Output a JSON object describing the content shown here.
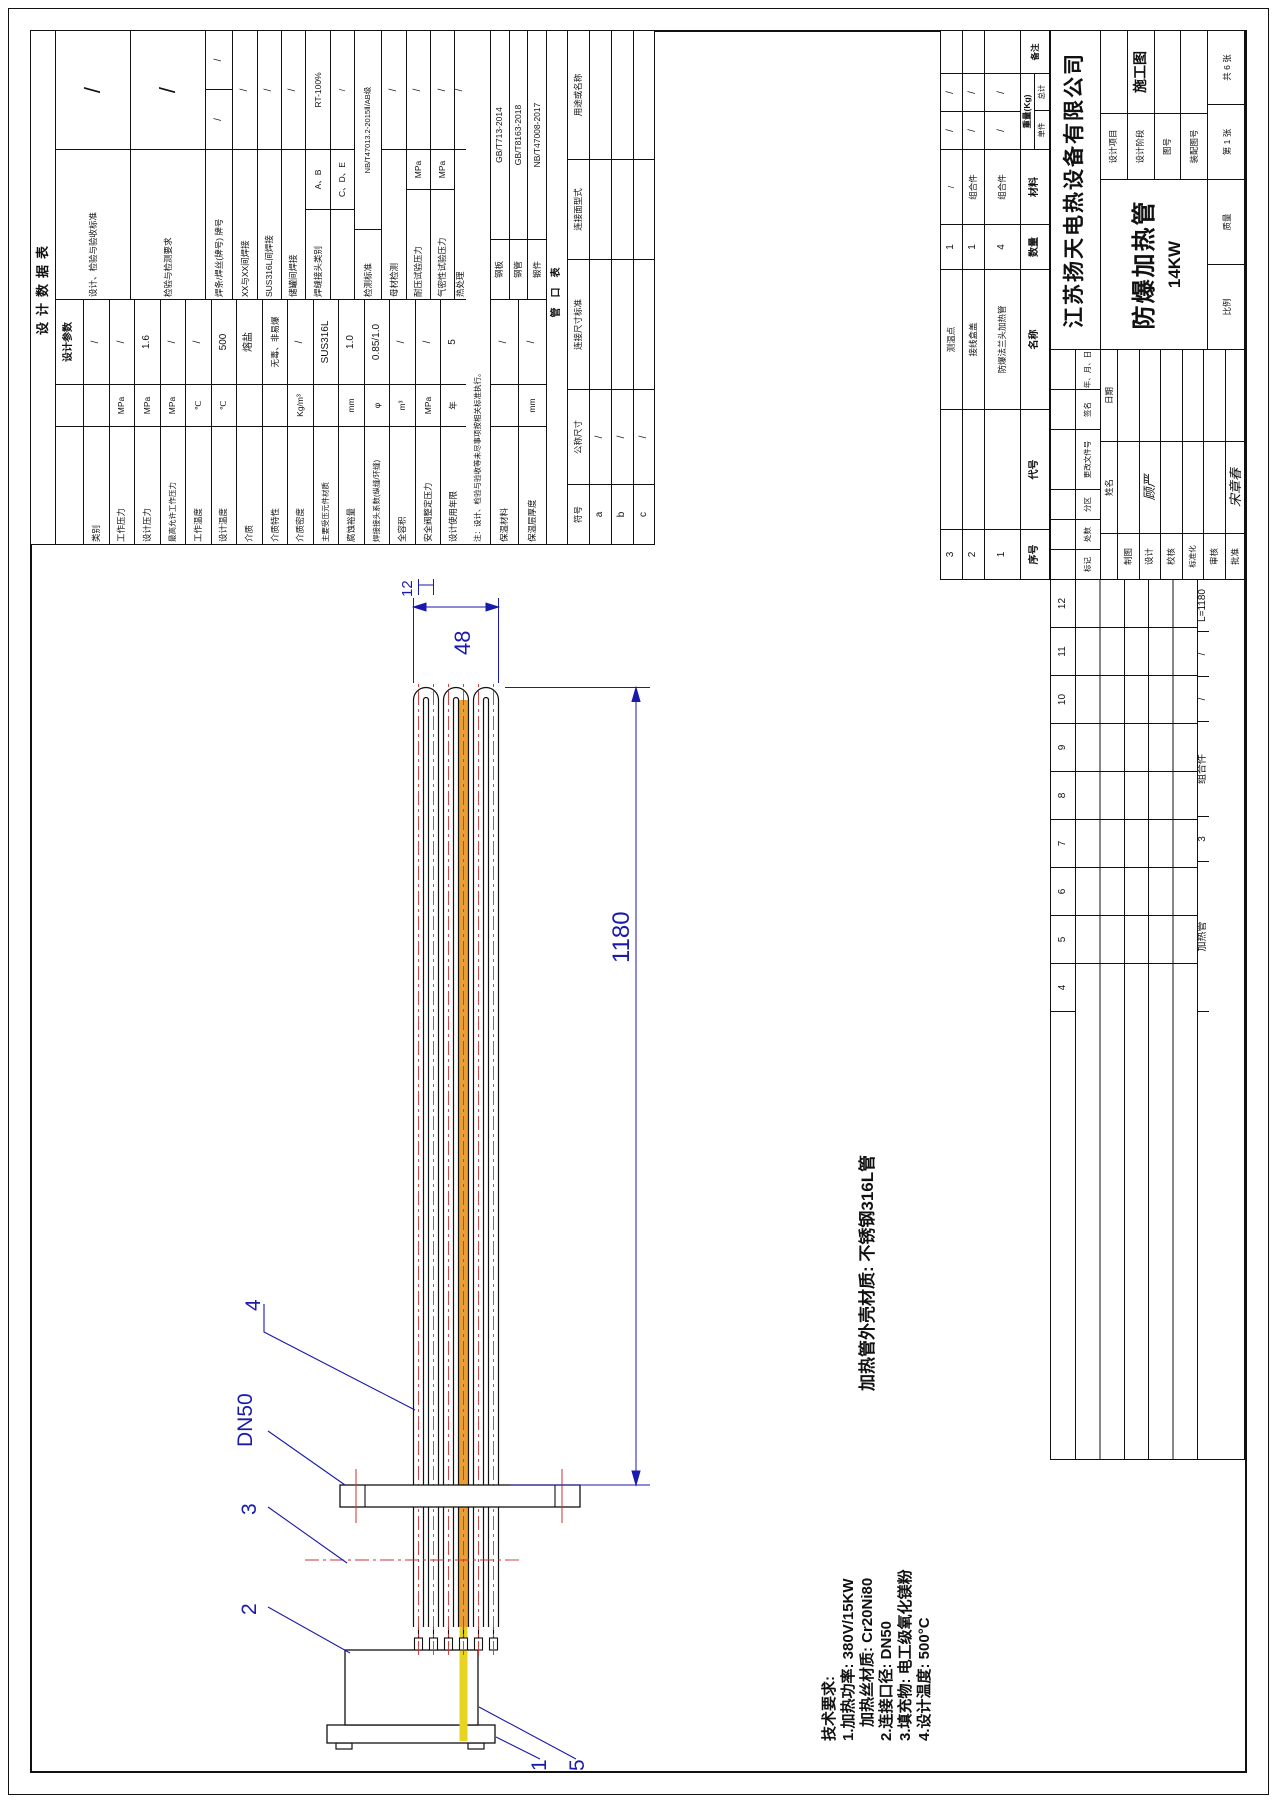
{
  "design_table": {
    "title": "设计数据表",
    "param_header": "设计参数",
    "params": [
      {
        "l": "类别",
        "u": "",
        "v": "/"
      },
      {
        "l": "工作压力",
        "u": "MPa",
        "v": "/"
      },
      {
        "l": "设计压力",
        "u": "MPa",
        "v": "1.6"
      },
      {
        "l": "最高允许工作压力",
        "u": "MPa",
        "v": "/"
      },
      {
        "l": "工作温度",
        "u": "℃",
        "v": "/"
      },
      {
        "l": "设计温度",
        "u": "℃",
        "v": "500"
      },
      {
        "l": "介质",
        "u": "",
        "v": "熔盐"
      },
      {
        "l": "介质特性",
        "u": "",
        "v": "无毒、非易爆"
      },
      {
        "l": "介质密度",
        "u": "Kg/m³",
        "v": "/"
      },
      {
        "l": "主要受压元件材质",
        "u": "",
        "v": "SUS316L"
      },
      {
        "l": "腐蚀裕量",
        "u": "mm",
        "v": "1.0"
      },
      {
        "l": "焊接接头系数(纵缝/环缝)",
        "u": "φ",
        "v": "0.85/1.0"
      },
      {
        "l": "全容积",
        "u": "m³",
        "v": "/"
      },
      {
        "l": "安全阀整定压力",
        "u": "MPa",
        "v": "/"
      },
      {
        "l": "设计使用年限",
        "u": "年",
        "v": "5"
      },
      {
        "l": "保温材料",
        "u": "",
        "v": "/"
      },
      {
        "l": "保温层厚度",
        "u": "mm",
        "v": "/"
      }
    ],
    "note": "注：设计、检验与验收等未尽事项按相关标准执行。",
    "right": {
      "std_label": "设计、检验与验收标准",
      "std_value": "/",
      "req_label": "检验与检测要求",
      "req_value": "/",
      "rod_label": "焊条/焊丝(牌号) 牌号",
      "rod_v1": "/",
      "rod_v2": "/",
      "weld_rows": [
        {
          "l": "XX与XX间焊接",
          "v": "/"
        },
        {
          "l": "SUS316L间焊接",
          "v": "/"
        },
        {
          "l": "储罐间焊接",
          "v": "/"
        }
      ],
      "joint_label": "焊缝接头类别",
      "joint_rows": [
        {
          "l": "A、B",
          "v": "RT-100%"
        },
        {
          "l": "C、D、E",
          "v": "/"
        }
      ],
      "det_std_label": "检测标准",
      "det_std_value": "NB/T47013.2-2015Ⅱ/AB级",
      "base_label": "母材检测",
      "base_value": "/",
      "press_label": "耐压试验压力",
      "press_unit": "MPa",
      "press_value": "/",
      "leak_label": "气密性试验压力",
      "leak_unit": "MPa",
      "leak_value": "/",
      "heat_label": "热处理",
      "heat_value": "/"
    },
    "standards": [
      {
        "l": "钢板",
        "v": "GB/T713-2014"
      },
      {
        "l": "钢管",
        "v": "GB/T8163-2018"
      },
      {
        "l": "锻件",
        "v": "NB/T47008-2017"
      }
    ],
    "nozzle": {
      "title": "管口表",
      "headers": [
        "符号",
        "公称尺寸",
        "连接尺寸标准",
        "连接面型式",
        "用途或名称"
      ],
      "rows": [
        [
          "a",
          "/"
        ],
        [
          "b",
          "/"
        ],
        [
          "c",
          "/"
        ]
      ]
    }
  },
  "bom": {
    "headers": {
      "no": "序号",
      "code": "代号",
      "name": "名称",
      "qty": "数量",
      "mat": "材料",
      "wt": "重量(Kg)",
      "w1": "单件",
      "w2": "总计",
      "rem": "备注"
    },
    "rows": [
      {
        "no": "3",
        "code": "",
        "name": "测温点",
        "qty": "1",
        "mat": "/",
        "w1": "/",
        "w2": "/",
        "rem": ""
      },
      {
        "no": "2",
        "code": "",
        "name": "接线盒盖",
        "qty": "1",
        "mat": "组合件",
        "w1": "/",
        "w2": "/",
        "rem": ""
      },
      {
        "no": "1",
        "code": "",
        "name": "防爆法兰头加热管",
        "qty": "4",
        "mat": "组合件",
        "w1": "/",
        "w2": "/",
        "rem": ""
      }
    ]
  },
  "strip": {
    "numbers": [
      "4",
      "5",
      "6",
      "7",
      "8",
      "9",
      "10",
      "11",
      "12"
    ],
    "item": {
      "name": "加热管",
      "qty": "3",
      "mat": "组合件",
      "w1": "/",
      "w2": "/",
      "rem": "L=1180"
    }
  },
  "title_block": {
    "company": "江苏扬天电热设备有限公司",
    "product": "防爆加热管",
    "power": "14KW",
    "stage_value": "施工图",
    "fields": [
      "设计项目",
      "设计阶段",
      "图号",
      "装配图号"
    ],
    "sheet_no": "第 1 张",
    "sheets_total": "共 6 张",
    "scale_label": "比例",
    "mass_label": "质量",
    "rev_headers": [
      "标记",
      "处数",
      "分区",
      "更改文件号",
      "签名",
      "年、月、日"
    ],
    "sig_name_header": "姓名",
    "sig_date_header": "日期",
    "signatures": [
      {
        "l": "制图",
        "n": ""
      },
      {
        "l": "设计",
        "n": "顾严"
      },
      {
        "l": "校核",
        "n": ""
      },
      {
        "l": "标准化",
        "n": ""
      },
      {
        "l": "审核",
        "n": ""
      },
      {
        "l": "批准",
        "n": "宋章春"
      }
    ]
  },
  "drawing": {
    "dim_length": "1180",
    "dim_width": "48",
    "dim_pitch": "12",
    "flange_label": "DN50",
    "callouts": [
      "1",
      "2",
      "3",
      "4",
      "5"
    ],
    "material_note": "加热管外壳材质: 不锈钢316L管"
  },
  "tech": {
    "lines": [
      "技术要求:",
      "1.加热功率: 380V/15KW",
      "加热丝材质: Cr20Ni80",
      "2.连接口径: DN50",
      "3.填充物: 电工级氧化镁粉",
      "4.设计温度: 500°C"
    ]
  }
}
